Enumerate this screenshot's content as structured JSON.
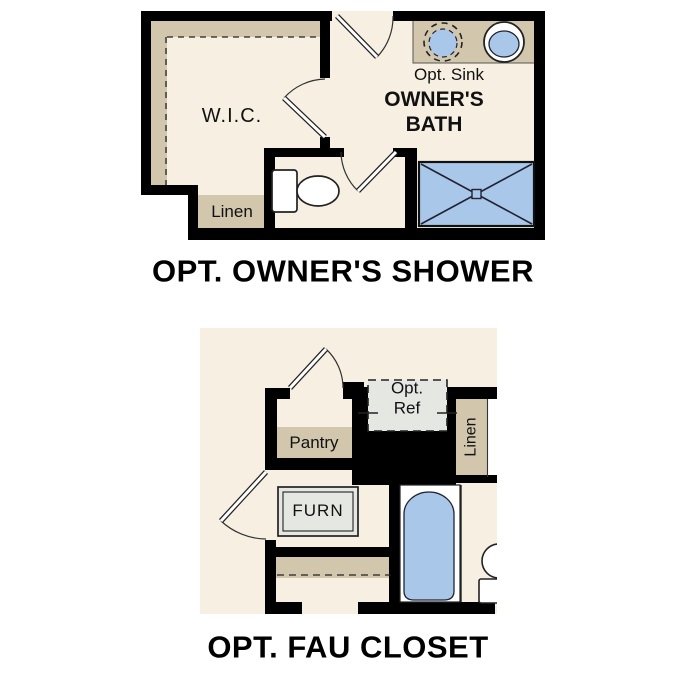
{
  "colors": {
    "floor": "#f7f0e2",
    "shelf": "#d2c7ad",
    "fixture_blue": "#a9c8e9",
    "equipment_gray": "#e5e7e3",
    "wall": "#000000"
  },
  "upper_plan": {
    "title": "OPT. OWNER'S SHOWER",
    "rooms": {
      "wic": "W.I.C.",
      "bath_line1": "OWNER'S",
      "bath_line2": "BATH"
    },
    "labels": {
      "linen": "Linen",
      "opt_sink": "Opt. Sink"
    },
    "fixtures": [
      "toilet-icon",
      "sink-icon",
      "optional-sink-icon",
      "shower-icon",
      "door-swing-icon"
    ]
  },
  "lower_plan": {
    "title": "OPT. FAU CLOSET",
    "labels": {
      "pantry": "Pantry",
      "opt_ref_line1": "Opt.",
      "opt_ref_line2": "Ref",
      "linen": "Linen",
      "furn": "FURN"
    },
    "fixtures": [
      "bathtub-icon",
      "toilet-icon",
      "furnace-icon",
      "optional-refrigerator-icon",
      "door-swing-icon"
    ]
  }
}
